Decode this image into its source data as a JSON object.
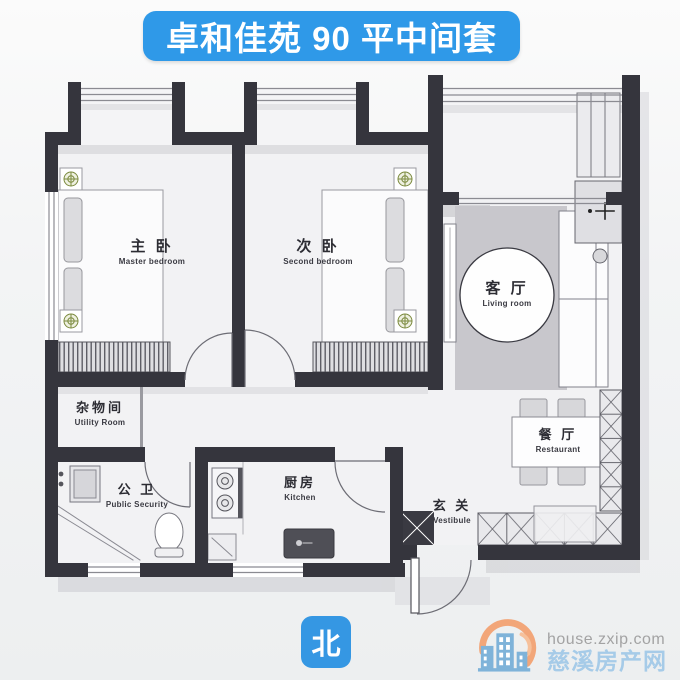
{
  "title": {
    "text": "卓和佳苑 90 平中间套"
  },
  "floor_plan": {
    "rooms": [
      {
        "id": "master-bedroom",
        "name_zh": "主 卧",
        "name_en": "Master bedroom"
      },
      {
        "id": "second-bedroom",
        "name_zh": "次 卧",
        "name_en": "Second bedroom"
      },
      {
        "id": "living-room",
        "name_zh": "客 厅",
        "name_en": "Living room"
      },
      {
        "id": "utility-room",
        "name_zh": "杂物间",
        "name_en": "Utility Room"
      },
      {
        "id": "bathroom",
        "name_zh": "公 卫",
        "name_en": "Public Security"
      },
      {
        "id": "kitchen",
        "name_zh": "厨房",
        "name_en": "Kitchen"
      },
      {
        "id": "vestibule",
        "name_zh": "玄 关",
        "name_en": "Vestibule"
      },
      {
        "id": "dining-room",
        "name_zh": "餐 厅",
        "name_en": "Restaurant"
      }
    ]
  },
  "compass": {
    "north_label": "北"
  },
  "watermark": {
    "site_url": "house.zxip.com",
    "site_name": "慈溪房产网"
  },
  "colors": {
    "banner_blue": "#2f99e8",
    "compass_blue": "#3597e3",
    "wall_dark": "#35353d",
    "living_rug_gray": "#c8c7cc",
    "watermark_url_gray": "#a3a3a3",
    "watermark_name_blue": "#a6cbe8",
    "logo_orange": "#f2a679",
    "logo_building_blue": "#7fb3d9",
    "fixture_green": "#7b8a3e"
  }
}
